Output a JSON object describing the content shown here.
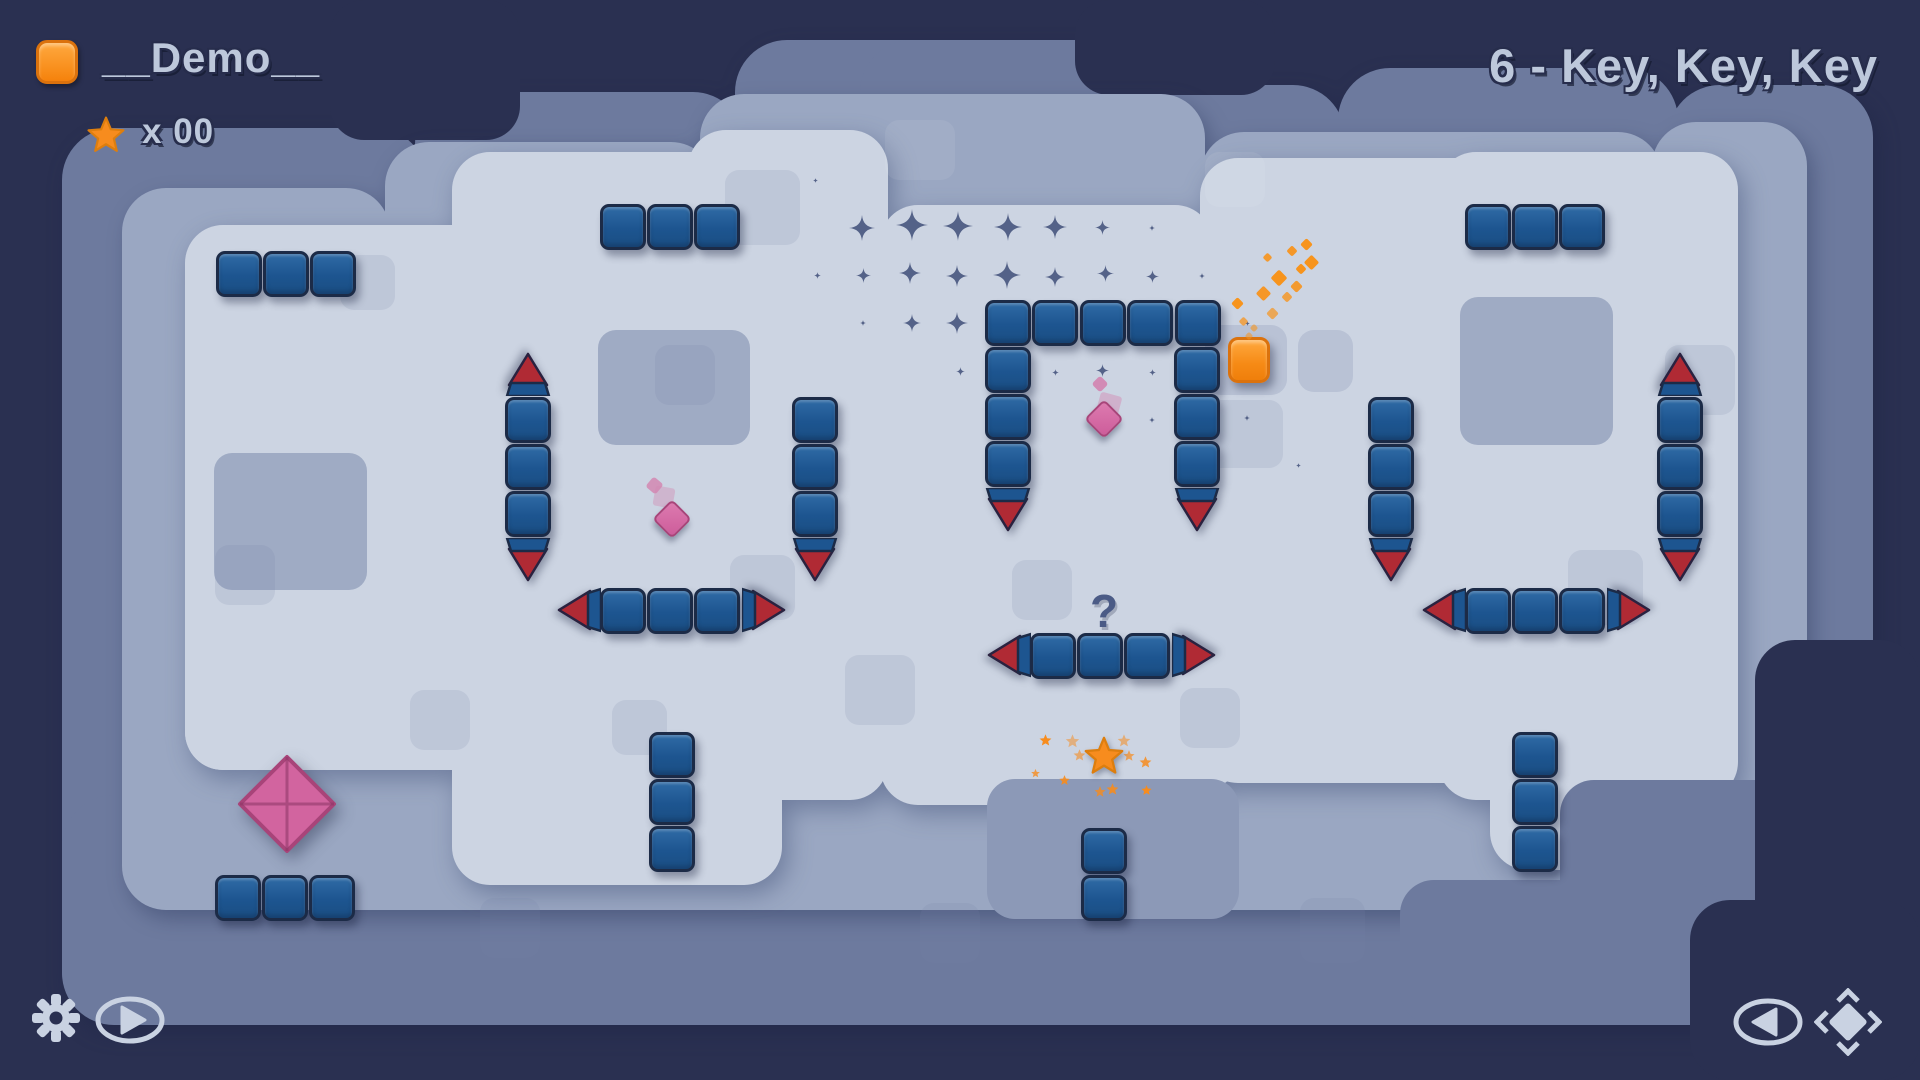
{
  "hud": {
    "level_name": "__Demo__",
    "star_count": "x 00",
    "level_title": "6 - Key, Key, Key"
  },
  "controls": {
    "settings": "settings",
    "play": "play",
    "back": "back",
    "recenter": "recenter"
  },
  "colors": {
    "bg": "#2a3051",
    "terrain_outer": "#6d7a9e",
    "terrain_band": "#9aa7c2",
    "terrain_field": "#ccd4e2",
    "ledge": "#8c99b7",
    "patch_big": "#9fabc4",
    "patch_mid": "#b9c2d5",
    "patch_faint": "rgba(116,132,170,0.16)",
    "patch_white": "rgba(255,255,255,0.07)",
    "block": "#1d5590",
    "block_border": "#1c2b47",
    "spike_red": "#b02a34",
    "pink": "#d2649f",
    "pink_border": "#a84479",
    "orange": "#f78c1e",
    "sparkle": "#47557e",
    "icon": "#c9d2e2",
    "question": "#4b5b86"
  },
  "level": {
    "question_mark": "?",
    "terrain": {
      "outer": [
        [
          62,
          128,
          365,
          895
        ],
        [
          415,
          92,
          330,
          930
        ],
        [
          735,
          40,
          430,
          985
        ],
        [
          1160,
          85,
          185,
          940
        ],
        [
          1338,
          68,
          340,
          955
        ],
        [
          1668,
          85,
          205,
          935
        ],
        [
          62,
          795,
          1810,
          230
        ],
        [
          860,
          40,
          330,
          140
        ]
      ],
      "dark_upper": [
        [
          330,
          0,
          190,
          140
        ],
        [
          1075,
          0,
          200,
          95
        ]
      ],
      "band": [
        [
          122,
          188,
          268,
          700
        ],
        [
          385,
          142,
          330,
          750
        ],
        [
          700,
          94,
          505,
          810
        ],
        [
          1200,
          132,
          462,
          755
        ],
        [
          1652,
          122,
          155,
          760
        ],
        [
          122,
          735,
          1545,
          175
        ],
        [
          1640,
          700,
          170,
          200
        ]
      ],
      "field": [
        [
          185,
          225,
          330,
          545
        ],
        [
          452,
          152,
          330,
          650
        ],
        [
          688,
          130,
          200,
          670
        ],
        [
          880,
          205,
          333,
          600
        ],
        [
          1200,
          158,
          335,
          625
        ],
        [
          1438,
          152,
          300,
          630
        ],
        [
          452,
          700,
          330,
          185
        ],
        [
          986,
          695,
          255,
          95
        ],
        [
          1438,
          690,
          300,
          110
        ],
        [
          185,
          560,
          230,
          210
        ],
        [
          1490,
          690,
          140,
          180
        ]
      ],
      "t1_stairs": [
        [
          1560,
          780,
          260,
          230
        ],
        [
          1400,
          880,
          320,
          145
        ]
      ],
      "ledges": [
        [
          987,
          779,
          252,
          140
        ]
      ],
      "dark_lower": [
        [
          1755,
          640,
          165,
          440
        ],
        [
          1690,
          900,
          230,
          180
        ]
      ],
      "patches_big": [
        [
          598,
          330,
          152,
          115
        ],
        [
          1460,
          297,
          153,
          148
        ],
        [
          214,
          453,
          153,
          137
        ]
      ],
      "patches_mid": [
        [
          1205,
          325,
          82,
          70
        ],
        [
          1298,
          330,
          55,
          62
        ]
      ],
      "patches_faint": [
        [
          725,
          170,
          75,
          75
        ],
        [
          655,
          345,
          60,
          60
        ],
        [
          845,
          655,
          70,
          70
        ],
        [
          730,
          555,
          65,
          65
        ],
        [
          612,
          700,
          55,
          55
        ],
        [
          1568,
          550,
          75,
          75
        ],
        [
          1300,
          898,
          65,
          65
        ],
        [
          480,
          898,
          60,
          60
        ],
        [
          215,
          545,
          60,
          60
        ],
        [
          1665,
          345,
          70,
          70
        ],
        [
          920,
          903,
          60,
          60
        ],
        [
          340,
          255,
          55,
          55
        ],
        [
          1012,
          560,
          60,
          60
        ],
        [
          1180,
          688,
          60,
          60
        ],
        [
          1203,
          400,
          80,
          68
        ],
        [
          410,
          690,
          60,
          60
        ]
      ],
      "patches_white": [
        [
          885,
          120,
          70,
          60
        ],
        [
          1205,
          152,
          60,
          55
        ]
      ]
    },
    "block_groups": [
      {
        "x": 216,
        "y": 251,
        "dx": 47,
        "dy": 0,
        "n": 3
      },
      {
        "x": 600,
        "y": 204,
        "dx": 47,
        "dy": 0,
        "n": 3
      },
      {
        "x": 1465,
        "y": 204,
        "dx": 47,
        "dy": 0,
        "n": 3
      },
      {
        "x": 215,
        "y": 875,
        "dx": 47,
        "dy": 0,
        "n": 3
      },
      {
        "x": 649,
        "y": 732,
        "dx": 0,
        "dy": 47,
        "n": 3
      },
      {
        "x": 1512,
        "y": 732,
        "dx": 0,
        "dy": 47,
        "n": 3
      },
      {
        "x": 1081,
        "y": 828,
        "dx": 0,
        "dy": 47,
        "n": 2
      },
      {
        "x": 985,
        "y": 300,
        "dx": 47.4,
        "dy": 0,
        "n": 5
      },
      {
        "x": 985,
        "y": 347,
        "dx": 0,
        "dy": 47,
        "n": 3
      },
      {
        "x": 1174,
        "y": 347,
        "dx": 0,
        "dy": 47,
        "n": 3
      },
      {
        "x": 505,
        "y": 397,
        "dx": 0,
        "dy": 47,
        "n": 3
      },
      {
        "x": 1657,
        "y": 397,
        "dx": 0,
        "dy": 47,
        "n": 3
      },
      {
        "x": 792,
        "y": 397,
        "dx": 0,
        "dy": 47,
        "n": 3
      },
      {
        "x": 1368,
        "y": 397,
        "dx": 0,
        "dy": 47,
        "n": 3
      },
      {
        "x": 600,
        "y": 588,
        "dx": 47,
        "dy": 0,
        "n": 3
      },
      {
        "x": 1465,
        "y": 588,
        "dx": 47,
        "dy": 0,
        "n": 3
      },
      {
        "x": 1030,
        "y": 633,
        "dx": 47,
        "dy": 0,
        "n": 3
      }
    ],
    "spikes": [
      {
        "x": 505,
        "y": 352,
        "dir": "up"
      },
      {
        "x": 505,
        "y": 538,
        "dir": "down"
      },
      {
        "x": 1657,
        "y": 352,
        "dir": "up"
      },
      {
        "x": 1657,
        "y": 538,
        "dir": "down"
      },
      {
        "x": 792,
        "y": 538,
        "dir": "down"
      },
      {
        "x": 1368,
        "y": 538,
        "dir": "down"
      },
      {
        "x": 985,
        "y": 488,
        "dir": "down"
      },
      {
        "x": 1174,
        "y": 488,
        "dir": "down"
      },
      {
        "x": 556,
        "y": 588,
        "dir": "left"
      },
      {
        "x": 741,
        "y": 588,
        "dir": "right"
      },
      {
        "x": 1421,
        "y": 588,
        "dir": "left"
      },
      {
        "x": 1606,
        "y": 588,
        "dir": "right"
      },
      {
        "x": 986,
        "y": 633,
        "dir": "left"
      },
      {
        "x": 1171,
        "y": 633,
        "dir": "right"
      }
    ],
    "player": {
      "x": 1228,
      "y": 337,
      "w": 42,
      "h": 46
    },
    "diamond_big": {
      "cx": 287,
      "cy": 804
    },
    "diamonds_small": [
      {
        "cx": 1104,
        "cy": 419
      },
      {
        "cx": 672,
        "cy": 519
      }
    ],
    "diamond_ghosts": [
      {
        "x": 1098,
        "y": 394,
        "s": 22,
        "o": 0.45,
        "r": 15
      },
      {
        "x": 1094,
        "y": 378,
        "s": 12,
        "o": 0.95,
        "r": 45
      },
      {
        "x": 654,
        "y": 487,
        "s": 20,
        "o": 0.4,
        "r": 10
      },
      {
        "x": 648,
        "y": 479,
        "s": 13,
        "o": 0.85,
        "r": 40
      }
    ],
    "star_main": {
      "cx": 1104,
      "cy": 757,
      "size": 46
    },
    "star_particles": [
      [
        1045,
        740,
        15,
        1
      ],
      [
        1072,
        741,
        17,
        0.5
      ],
      [
        1079,
        755,
        15,
        0.6
      ],
      [
        1124,
        741,
        16,
        0.55
      ],
      [
        1129,
        756,
        14,
        0.7
      ],
      [
        1145,
        762,
        15,
        0.85
      ],
      [
        1064,
        780,
        13,
        0.9
      ],
      [
        1100,
        792,
        14,
        0.8
      ],
      [
        1112,
        789,
        15,
        0.9
      ],
      [
        1146,
        790,
        13,
        1
      ],
      [
        1035,
        773,
        11,
        0.8
      ]
    ],
    "orange_particles": [
      [
        1233,
        299,
        9,
        1
      ],
      [
        1240,
        318,
        7,
        0.75
      ],
      [
        1251,
        325,
        6,
        0.6
      ],
      [
        1258,
        288,
        11,
        0.95
      ],
      [
        1268,
        309,
        9,
        0.7
      ],
      [
        1273,
        272,
        12,
        1
      ],
      [
        1283,
        293,
        8,
        0.8
      ],
      [
        1292,
        282,
        9,
        0.9
      ],
      [
        1297,
        265,
        8,
        1
      ],
      [
        1306,
        257,
        11,
        1
      ],
      [
        1246,
        333,
        6,
        0.55
      ],
      [
        1264,
        254,
        7,
        0.9
      ],
      [
        1288,
        247,
        8,
        0.95
      ],
      [
        1302,
        240,
        9,
        1
      ]
    ],
    "sparkles": [
      [
        862,
        228,
        26
      ],
      [
        912,
        225,
        32
      ],
      [
        958,
        226,
        30
      ],
      [
        1008,
        227,
        28
      ],
      [
        1055,
        227,
        24
      ],
      [
        1102,
        227,
        15
      ],
      [
        1152,
        228,
        6
      ],
      [
        863,
        275,
        15
      ],
      [
        910,
        273,
        22
      ],
      [
        957,
        276,
        22
      ],
      [
        1007,
        275,
        28
      ],
      [
        1055,
        277,
        20
      ],
      [
        1105,
        273,
        17
      ],
      [
        1152,
        276,
        13
      ],
      [
        1202,
        276,
        6
      ],
      [
        863,
        323,
        6
      ],
      [
        912,
        323,
        18
      ],
      [
        957,
        323,
        22
      ],
      [
        1007,
        323,
        9
      ],
      [
        1152,
        323,
        5
      ],
      [
        960,
        371,
        9
      ],
      [
        1055,
        372,
        7
      ],
      [
        1102,
        370,
        13
      ],
      [
        1152,
        372,
        7
      ],
      [
        1152,
        420,
        6
      ],
      [
        1247,
        418,
        6
      ],
      [
        1298,
        465,
        5
      ],
      [
        1247,
        323,
        5
      ],
      [
        815,
        180,
        5
      ],
      [
        817,
        275,
        7
      ]
    ]
  }
}
